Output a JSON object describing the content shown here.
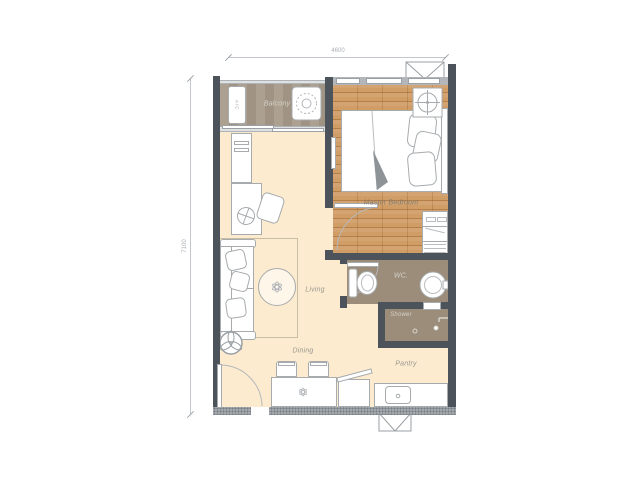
{
  "floor_plan": {
    "dimension_top": "4600",
    "dimension_left": "7100",
    "rooms": {
      "balcony": "Balcony",
      "master_bedroom": "Master Bedroom",
      "living": "Living",
      "dining": "Dining",
      "pantry": "Pantry",
      "wc": "WC.",
      "shower": "Shower"
    },
    "labels": {
      "ac_unit": "A/C"
    },
    "colors": {
      "wall": "#4d535b",
      "wood_floor": "#d09d66",
      "living_floor": "#fcebce",
      "bathroom_floor": "#9c8d7a",
      "balcony_floor": "#a89b8a",
      "fixture_outline": "#a7abae",
      "label_text": "#8f9195"
    }
  }
}
